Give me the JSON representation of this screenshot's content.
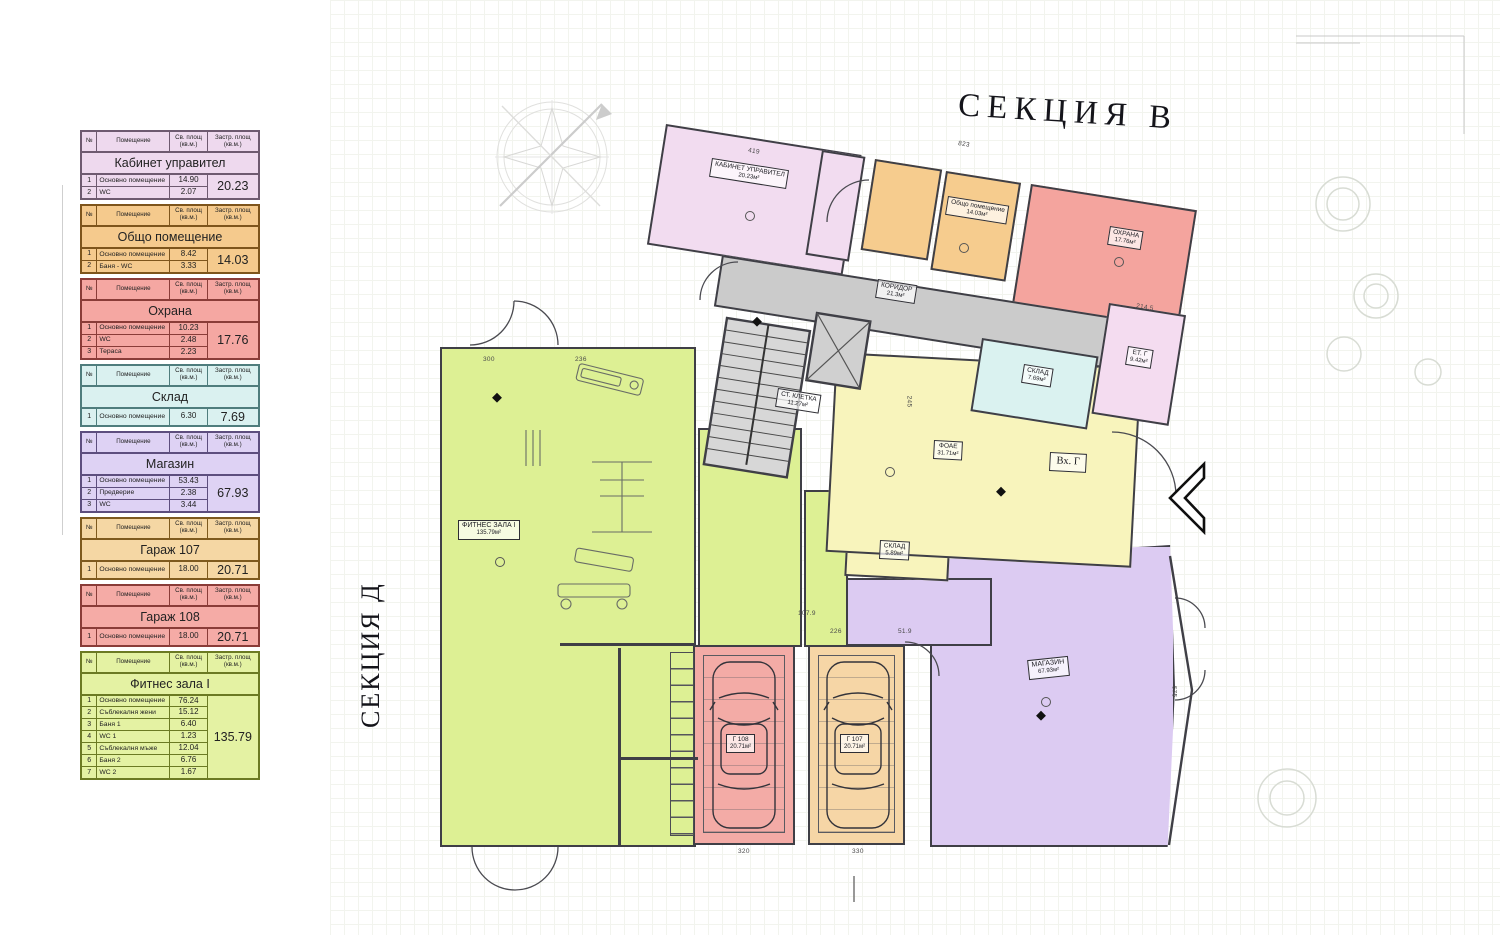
{
  "titles": {
    "section_top": "СЕКЦИЯ В",
    "section_left": "СЕКЦИЯ Д"
  },
  "legend": {
    "columns": {
      "num": "№",
      "room": "Помещение",
      "clear": "Св. площ\n(кв.м.)",
      "built": "Застр. площ\n(кв.м.)"
    },
    "sections": [
      {
        "title": "Кабинет управител",
        "fill": "#eed9ee",
        "border": "#6e5a70",
        "rows": [
          [
            "1",
            "Основно помещение",
            "14.90"
          ],
          [
            "2",
            "WC",
            "2.07"
          ]
        ],
        "total": "20.23"
      },
      {
        "title": "Общо помещение",
        "fill": "#f5ca8d",
        "border": "#7e551c",
        "rows": [
          [
            "1",
            "Основно помещение",
            "8.42"
          ],
          [
            "2",
            "Баня - WC",
            "3.33"
          ]
        ],
        "total": "14.03"
      },
      {
        "title": "Охрана",
        "fill": "#f5a7a2",
        "border": "#8a3c38",
        "rows": [
          [
            "1",
            "Основно помещение",
            "10.23"
          ],
          [
            "2",
            "WC",
            "2.48"
          ],
          [
            "3",
            "Тераса",
            "2.23"
          ]
        ],
        "total": "17.76"
      },
      {
        "title": "Склад",
        "fill": "#daf1f0",
        "border": "#4f7d7d",
        "rows": [
          [
            "1",
            "Основно помещение",
            "6.30"
          ]
        ],
        "total": "7.69"
      },
      {
        "title": "Магазин",
        "fill": "#ded2f4",
        "border": "#5d4e7e",
        "rows": [
          [
            "1",
            "Основно помещение",
            "53.43"
          ],
          [
            "2",
            "Предверие",
            "2.38"
          ],
          [
            "3",
            "WC",
            "3.44"
          ]
        ],
        "total": "67.93"
      },
      {
        "title": "Гараж 107",
        "fill": "#f5d7a4",
        "border": "#7e5a1e",
        "rows": [
          [
            "1",
            "Основно помещение",
            "18.00"
          ]
        ],
        "total": "20.71"
      },
      {
        "title": "Гараж 108",
        "fill": "#f5aba6",
        "border": "#8a3c38",
        "rows": [
          [
            "1",
            "Основно помещение",
            "18.00"
          ]
        ],
        "total": "20.71"
      },
      {
        "title": "Фитнес зала I",
        "fill": "#e4f2a3",
        "border": "#6b7a23",
        "rows": [
          [
            "1",
            "Основно помещение",
            "76.24"
          ],
          [
            "2",
            "Съблекалня жени",
            "15.12"
          ],
          [
            "3",
            "Баня 1",
            "6.40"
          ],
          [
            "4",
            "WC 1",
            "1.23"
          ],
          [
            "5",
            "Съблекалня мъже",
            "12.04"
          ],
          [
            "6",
            "Баня 2",
            "6.76"
          ],
          [
            "7",
            "WC 2",
            "1.67"
          ]
        ],
        "total": "135.79"
      }
    ]
  },
  "plan": {
    "rooms": {
      "office": {
        "name": "КАБИНЕТ УПРАВИТЕЛ",
        "area": "20.23м²"
      },
      "common": {
        "name": "Общо помещение",
        "area": "14.03м²"
      },
      "security": {
        "name": "ОХРАНА",
        "area": "17.76м²"
      },
      "corridor": {
        "name": "КОРИДОР",
        "area": "21.3м²"
      },
      "stairs": {
        "name": "СТ. КЛЕТКА",
        "area": "11.27м²"
      },
      "storage": {
        "name": "СКЛАД",
        "area": "7.69м²"
      },
      "storage_small": {
        "name": "СКЛАД",
        "area": "5.89м²"
      },
      "et_room": {
        "name": "ЕТ. Г",
        "area": "9.42м²"
      },
      "foyer": {
        "name": "ФОАЕ",
        "area": "31.71м²"
      },
      "entrance": {
        "name": "Вх. Г"
      },
      "fitness": {
        "name": "ФИТНЕС ЗАЛА I",
        "area": "135.79м²"
      },
      "shop": {
        "name": "МАГАЗИН",
        "area": "67.93м²"
      },
      "garage108": {
        "name": "Г 108",
        "area": "20.71м²"
      },
      "garage107": {
        "name": "Г 107",
        "area": "20.71м²"
      }
    },
    "dimensions": [
      "419",
      "823",
      "214.5",
      "236",
      "300",
      "245",
      "107.9",
      "226",
      "51.9",
      "675",
      "320",
      "330"
    ]
  }
}
